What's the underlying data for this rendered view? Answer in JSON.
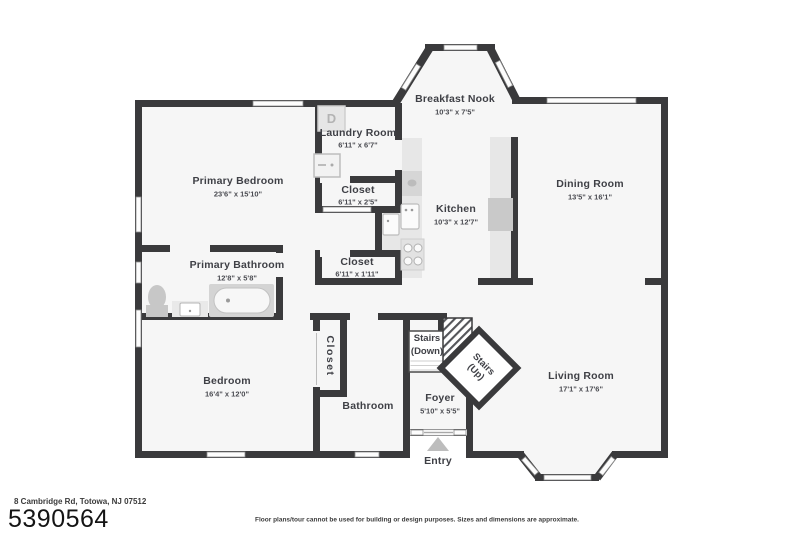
{
  "footer": {
    "address": "8 Cambridge Rd, Totowa, NJ 07512",
    "mls_number": "5390564",
    "disclaimer": "Floor plans/tour cannot be used for building or design purposes. Sizes and dimensions are approximate."
  },
  "colors": {
    "wall": "#3a3a3c",
    "floor": "#f6f6f6",
    "label": "#3f4046",
    "fixture_gray": "#d4d4d4"
  },
  "rooms": {
    "primary_bedroom": {
      "label": "Primary Bedroom",
      "dims": "23'6\" x 15'10\""
    },
    "laundry_room": {
      "label": "Laundry Room",
      "dims": "6'11\" x 6'7\""
    },
    "closet_1": {
      "label": "Closet",
      "dims": "6'11\" x 2'5\""
    },
    "closet_2": {
      "label": "Closet",
      "dims": "6'11\" x 1'11\""
    },
    "kitchen": {
      "label": "Kitchen",
      "dims": "10'3\" x 12'7\""
    },
    "breakfast_nook": {
      "label": "Breakfast Nook",
      "dims": "10'3\" x 7'5\""
    },
    "dining_room": {
      "label": "Dining Room",
      "dims": "13'5\" x 16'1\""
    },
    "primary_bathroom": {
      "label": "Primary Bathroom",
      "dims": "12'8\" x 5'8\""
    },
    "bedroom": {
      "label": "Bedroom",
      "dims": "16'4\" x 12'0\""
    },
    "closet_3": {
      "label": "Closet"
    },
    "bathroom": {
      "label": "Bathroom"
    },
    "foyer": {
      "label": "Foyer",
      "dims": "5'10\" x 5'5\""
    },
    "living_room": {
      "label": "Living Room",
      "dims": "17'1\" x 17'6\""
    }
  },
  "stairs": {
    "down_line1": "Stairs",
    "down_line2": "(Down)",
    "up_line1": "Stairs",
    "up_line2": "(Up)"
  },
  "entry": {
    "label": "Entry"
  },
  "fixtures": {
    "dryer_label": "D"
  }
}
